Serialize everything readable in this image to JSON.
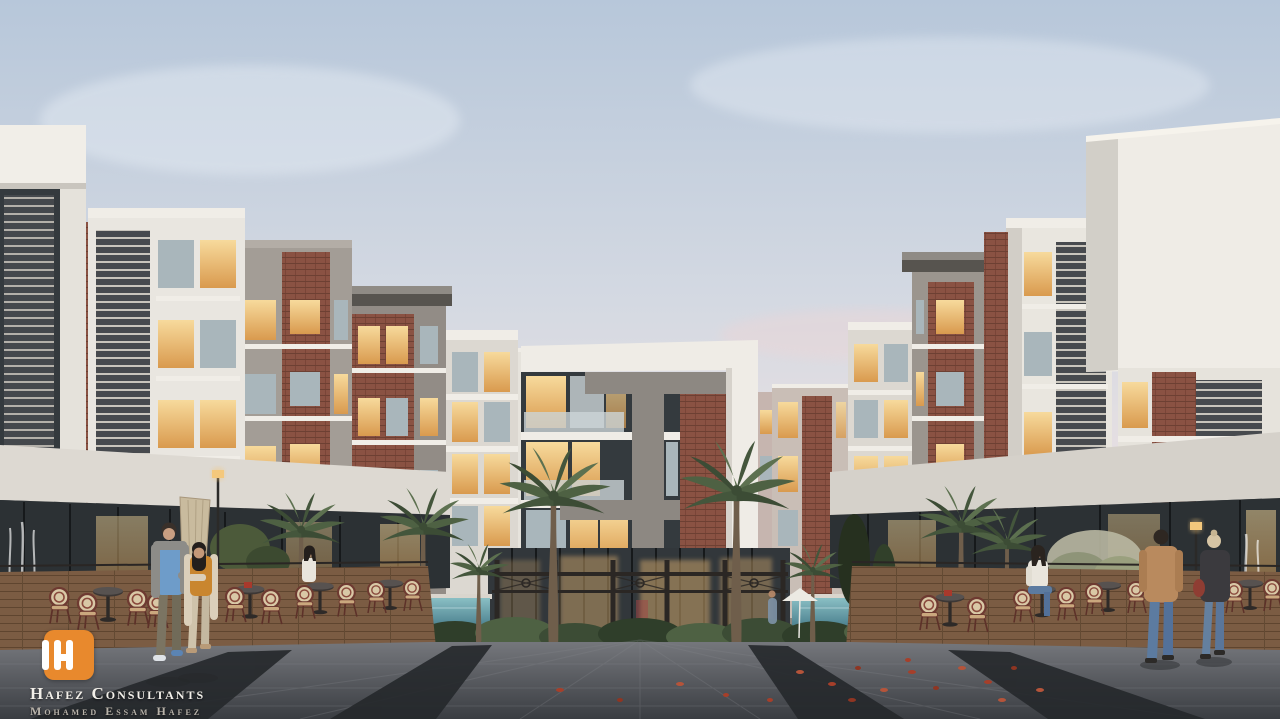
{
  "meta": {
    "scene_description": "Dusk architectural rendering of a modern residential compound courtyard with brick-and-white apartment wings, palm trees, pools, outdoor cafe seating and a wide stone plaza"
  },
  "watermark": {
    "brand": "Hafez Consultants",
    "person": "Mohamed Essam Hafez",
    "tagline": "Architects • Planners • Interior Designers",
    "monogram": "IH",
    "logo_color": "#e8892d"
  },
  "palette": {
    "sky_top": "#b7c7da",
    "sky_horizon": "#ecdfdf",
    "facade_white": "#edeae4",
    "facade_gray": "#9e9891",
    "brick": "#8a5243",
    "window_warm": "#f0c27c",
    "pool_water": "#5f9fae",
    "plaza": "#46494e",
    "plaza_band": "#25282b",
    "wood_deck": "#7b5c43",
    "foliage": "#4e6143",
    "autumn_leaf": "#a63f2a",
    "logo_orange": "#e8892d"
  }
}
